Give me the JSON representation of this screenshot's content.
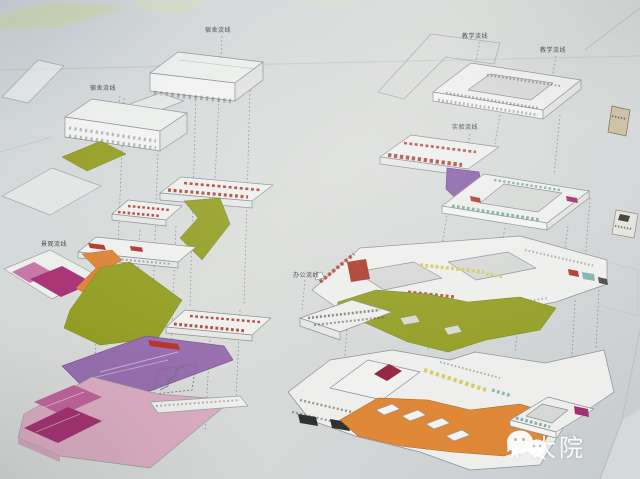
{
  "annotations": {
    "dorm_top": "宿舍流线",
    "dorm_mid": "宿舍流线",
    "teach_left": "教学流线",
    "teach_right": "教学流线",
    "lab": "实验流线",
    "office": "办公流线",
    "landscape": "景观流线"
  },
  "watermark": {
    "text": "中大院",
    "icon": "wechat-icon"
  },
  "colors": {
    "paper": "#d9dbda",
    "photo_tint": "#ccd3d8",
    "olive_green": "#95a018",
    "orange": "#e8872f",
    "magenta": "#ab2a72",
    "pink": "#e3aec6",
    "purple": "#9a6cb4",
    "red": "#b5372a",
    "crimson": "#9c1f3f",
    "yellow": "#d9cf52",
    "teal": "#7fb6ae",
    "line_grey": "#8a9094"
  }
}
